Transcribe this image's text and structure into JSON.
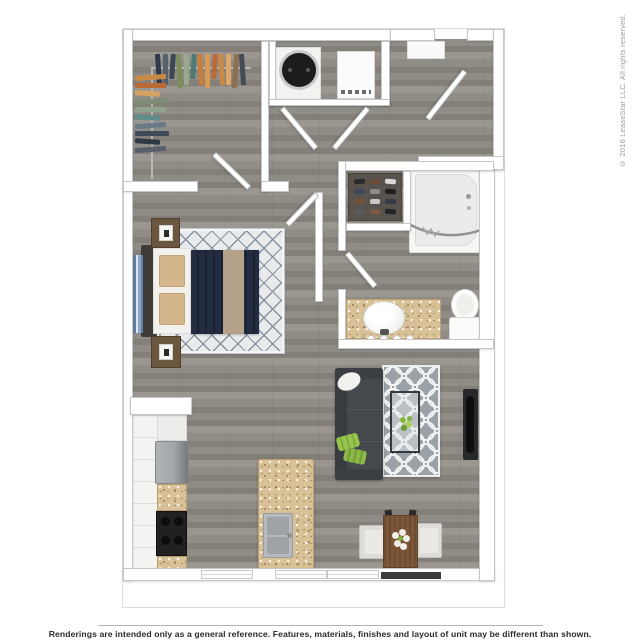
{
  "footer": {
    "disclaimer": "Renderings are intended only as a general reference. Features, materials, finishes and layout of unit may be different than shown."
  },
  "sidebar": {
    "copyright": "© 2016 LeaseStar LLC. All rights reserved."
  },
  "colors": {
    "frame-border": "#dedede",
    "wall": "#ffffff",
    "wall-border": "#c6c6c6",
    "floor-base": "#908d87",
    "floor-dark": "#847f79",
    "floor-light": "#9b9790",
    "granite": "#d8c196",
    "rug-bedroom": "#e9eaec",
    "rug-lattice": "#8792a0",
    "rug-living": "#9aa1a7",
    "sofa": "#45494e",
    "navy-bedding": "#242c42",
    "tan-throw": "#b3a189",
    "accent-green": "#97c64f",
    "wood-table": "#7c5637",
    "tv-black": "#0d0e0f",
    "appliance-gray": "#a3a6a9",
    "shoe-shelf": "#59534d"
  },
  "closet": {
    "clothes_top": [
      "#2e3a4a",
      "#55616e",
      "#3b4754",
      "#7d8c5c",
      "#9aa98e",
      "#4f7a74",
      "#c77f3f",
      "#d99a55",
      "#b96a35",
      "#c98a45",
      "#e0a868",
      "#8a6f52",
      "#444b55"
    ],
    "clothes_side": [
      "#c98a45",
      "#b96a35",
      "#d9a263",
      "#7f8d77",
      "#8fa08c",
      "#5f8f8a",
      "#6b7a88",
      "#3e4a58",
      "#2f3946",
      "#565f6b"
    ]
  },
  "bathroom": {
    "shoes": [
      "#2b2b2e",
      "#6b4a36",
      "#d8d8d8",
      "#3e4756",
      "#8c8c8c",
      "#1f1f22",
      "#74513c",
      "#c9c9c9",
      "#333a46",
      "#5a5a5e",
      "#7c5a43",
      "#23252b"
    ]
  }
}
